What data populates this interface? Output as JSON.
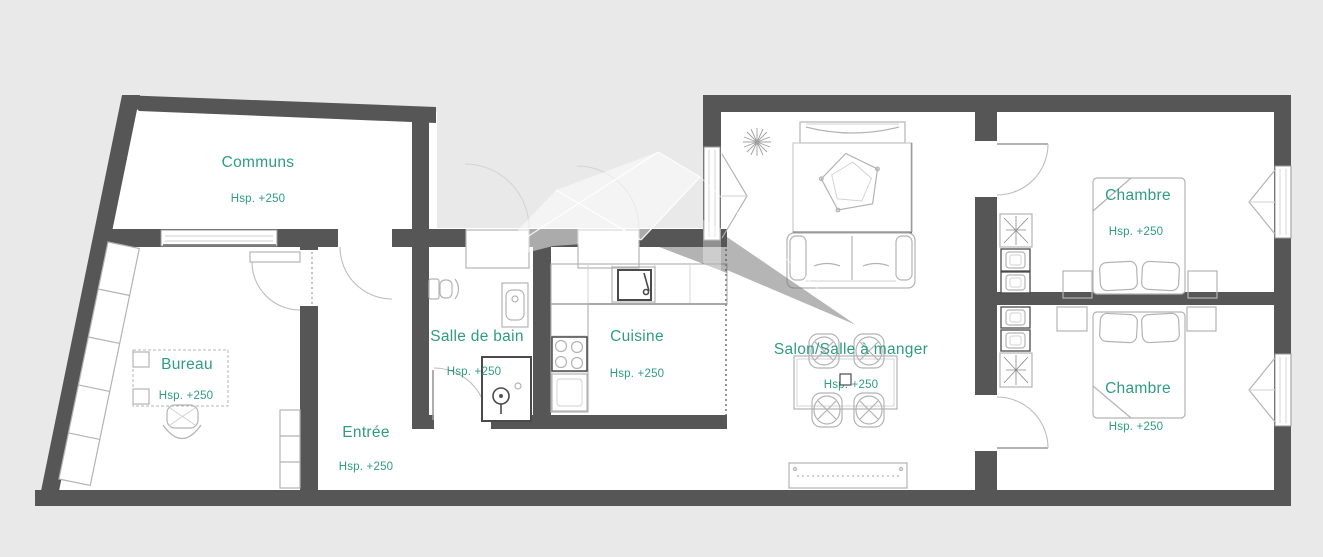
{
  "plan": {
    "rooms": [
      {
        "name": "Communs",
        "height_label": "Hsp. +250"
      },
      {
        "name": "Bureau",
        "height_label": "Hsp. +250"
      },
      {
        "name": "Entrée",
        "height_label": "Hsp. +250"
      },
      {
        "name": "Salle de bain",
        "height_label": "Hsp. +250"
      },
      {
        "name": "Cuisine",
        "height_label": "Hsp. +250"
      },
      {
        "name": "Salon/Salle à manger",
        "height_label": "Hsp. +250"
      },
      {
        "name": "Chambre",
        "height_label": "Hsp. +250"
      },
      {
        "name": "Chambre",
        "height_label": "Hsp. +250"
      }
    ],
    "colors": {
      "background": "#e9e9e9",
      "wall": "#565656",
      "floor": "#ffffff",
      "label_text": "#2f9c81",
      "furniture_line": "#b3b3b3",
      "furniture_dark": "#4a4a4a"
    }
  }
}
